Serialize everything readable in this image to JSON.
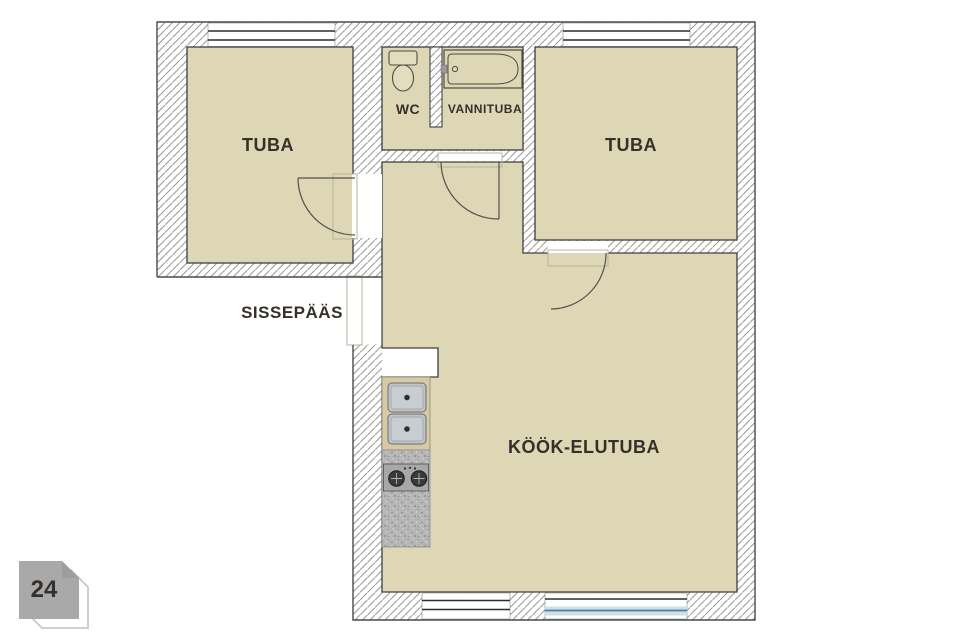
{
  "floorplan": {
    "labels": {
      "tuba_left": "TUBA",
      "wc": "WC",
      "vannituba": "VANNITUBA",
      "tuba_right": "TUBA",
      "sissepaas": "SISSEPÄÄS",
      "kook_elutuba": "KÖÖK-ELUTUBA"
    },
    "fixtures": {
      "toilet": "toilet",
      "bathtub": "bathtub",
      "sink": "kitchen-double-sink",
      "stove": "stove-two-burners"
    },
    "colors": {
      "room_fill": "#ddd7b6",
      "wall_line": "#454545",
      "hatch_line": "#9d9d9d",
      "text": "#35302b",
      "window_blue": "#4e7d9e",
      "window_blue_light": "#cfe0ea",
      "counter": "#d6c9a6",
      "steel": "#bfc4c8",
      "granite": "#b6b6b6",
      "badge": "#a9a9a9"
    }
  },
  "watermark": {
    "label": "24"
  }
}
